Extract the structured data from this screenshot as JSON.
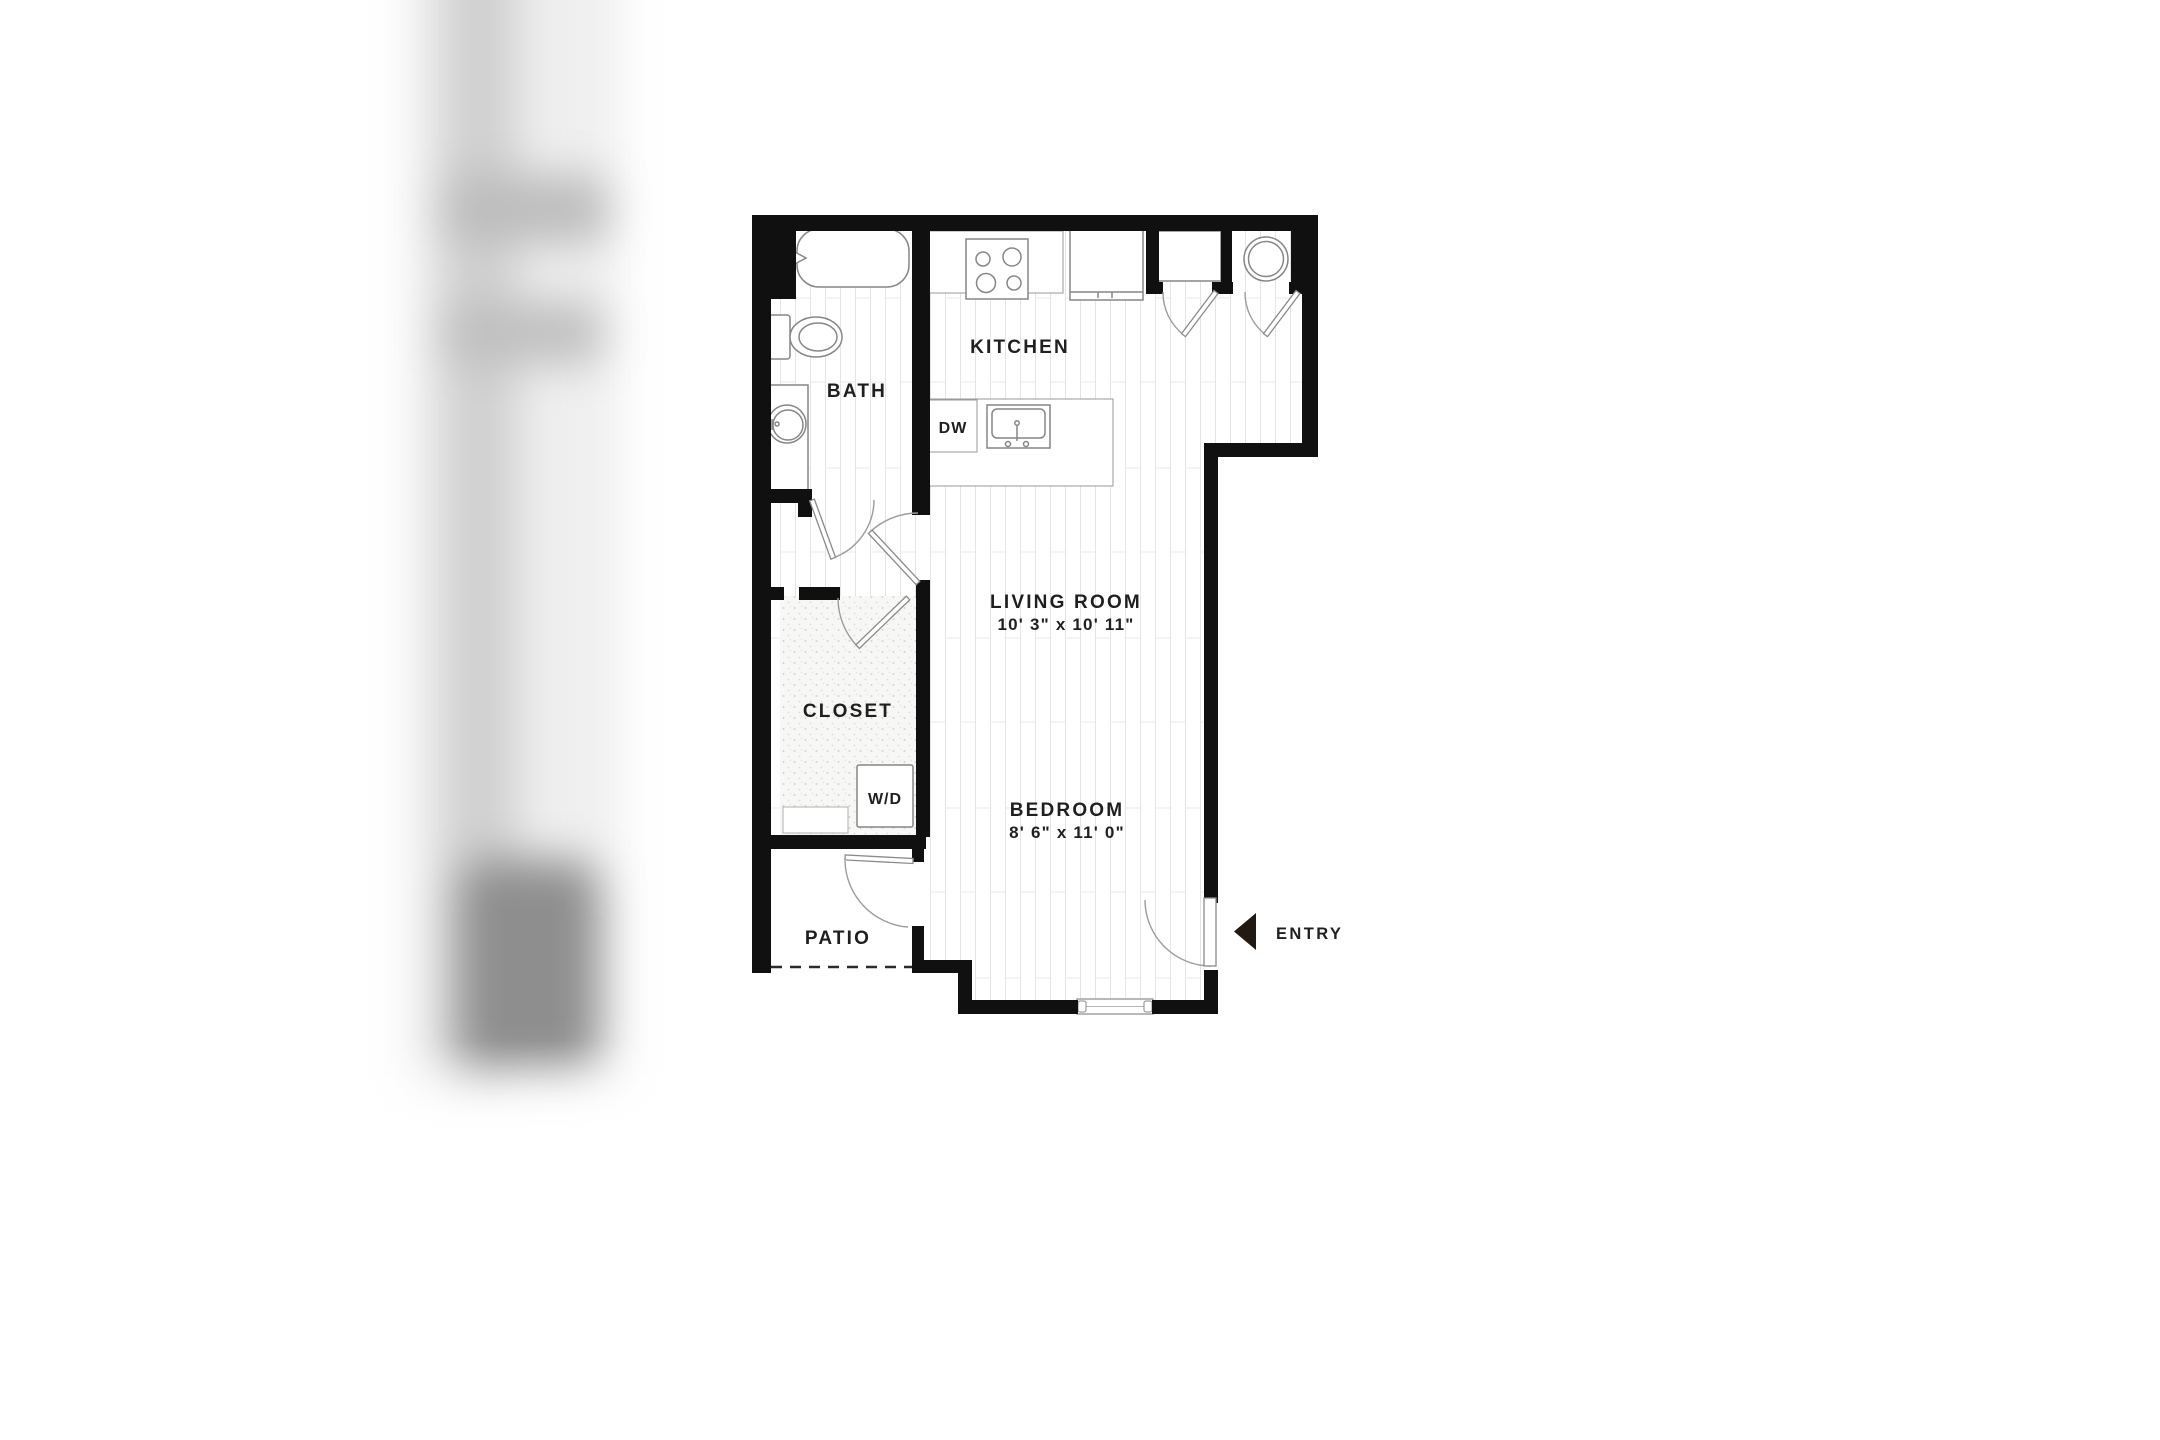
{
  "canvas": {
    "background": "#ffffff"
  },
  "floor_plan": {
    "colors": {
      "wall": "#101010",
      "label": "#1f1f1f",
      "fixture_line": "#868686",
      "door_line": "#9c9c9c",
      "arrow": "#221a12"
    },
    "labels": {
      "kitchen": "KITCHEN",
      "bath": "BATH",
      "dishwasher": "DW",
      "washer_dryer": "W/D",
      "closet": "CLOSET",
      "patio": "PATIO",
      "entry": "ENTRY",
      "living_room": {
        "name": "LIVING ROOM",
        "dimensions": "10' 3\" x 10' 11\""
      },
      "bedroom": {
        "name": "BEDROOM",
        "dimensions": "8' 6\" x 11' 0\""
      }
    }
  }
}
